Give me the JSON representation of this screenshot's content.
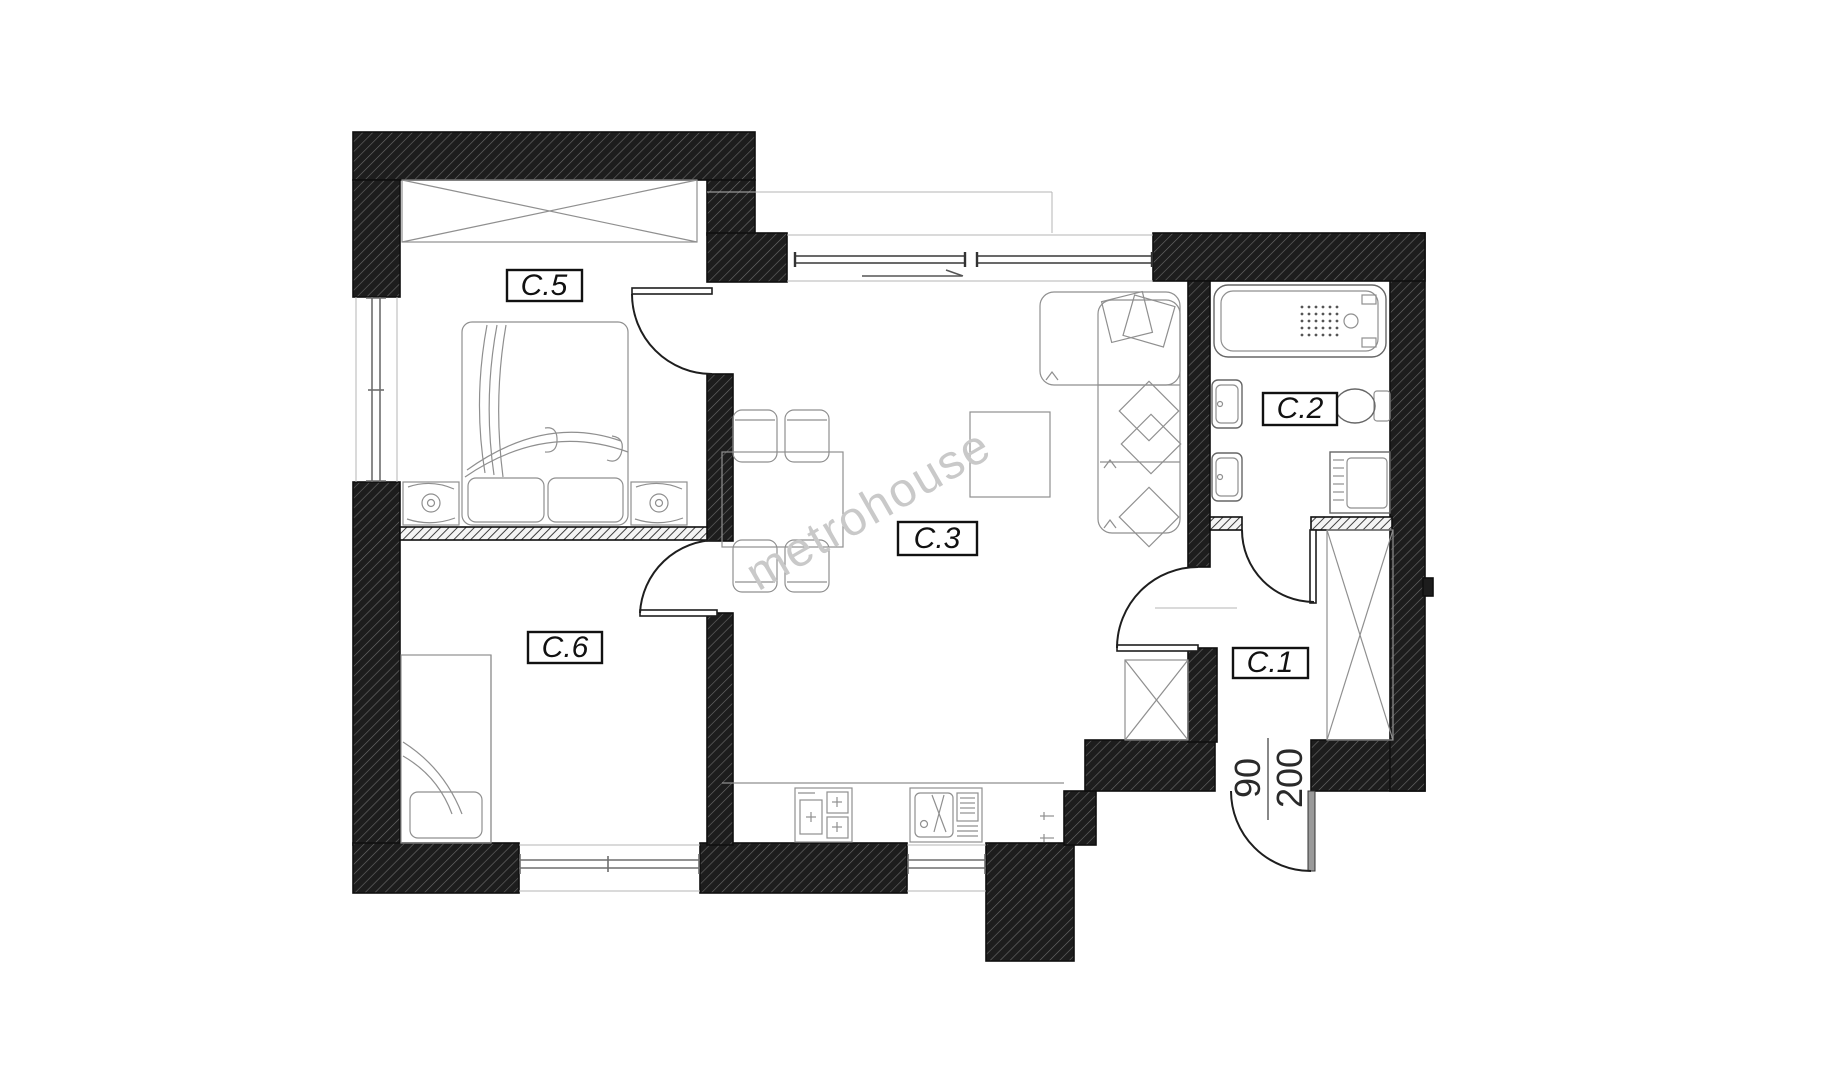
{
  "plan": {
    "title": "apartment-floor-plan",
    "watermark": "metrohouse",
    "rooms": {
      "c1": {
        "label": "C.1"
      },
      "c2": {
        "label": "C.2"
      },
      "c3": {
        "label": "C.3"
      },
      "c5": {
        "label": "C.5"
      },
      "c6": {
        "label": "C.6"
      }
    },
    "entrance_door_dimension": {
      "width_cm": "90",
      "height_cm": "200"
    },
    "colors": {
      "wall": "#1d1d1d",
      "wall_hatch_line": "#6b6b6b",
      "furniture_line": "#8f8f8f",
      "door_line": "#1e1e1e",
      "watermark": "#c9c9c9",
      "background": "#ffffff"
    }
  }
}
